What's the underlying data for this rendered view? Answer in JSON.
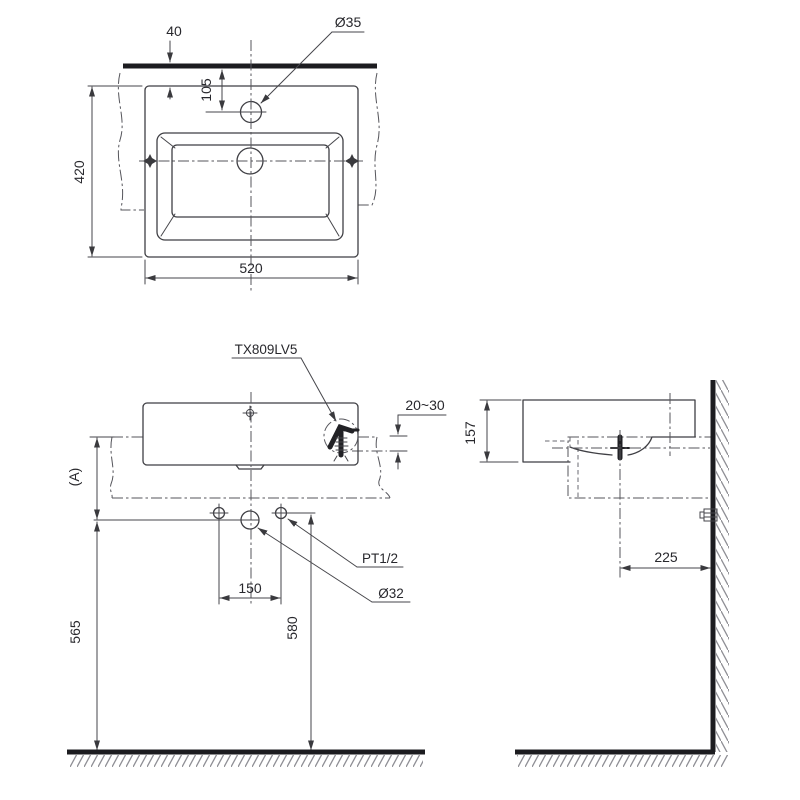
{
  "drawing": {
    "product_code": "TX809LV5",
    "top_view": {
      "faucet_hole_diameter": "Ø35",
      "wall_to_basin": "40",
      "wall_to_faucet_hole": "105",
      "basin_depth": "420",
      "basin_width": "520"
    },
    "front_view": {
      "counter_thickness": "20~30",
      "height_reference": "(A)",
      "supply_spacing": "150",
      "drain_height": "565",
      "supply_height": "580",
      "supply_thread": "PT1/2",
      "drain_diameter": "Ø32"
    },
    "side_view": {
      "basin_height": "157",
      "drain_to_wall": "225"
    },
    "colors": {
      "line": "#3f3f44",
      "thick_line": "#1c1c20",
      "centerline": "#55555b",
      "hatch": "#8e8e94",
      "text": "#28282d",
      "background": "#ffffff"
    }
  }
}
